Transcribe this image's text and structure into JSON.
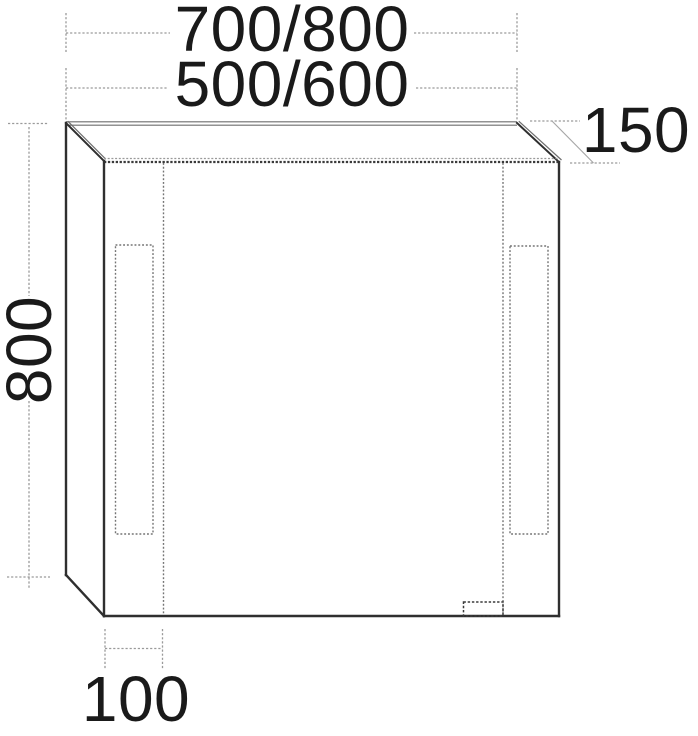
{
  "drawing": {
    "subject": "mirror-cabinet-technical-drawing",
    "dimension_labels": {
      "top_width_large": "700/800",
      "top_width_small": "500/600",
      "depth": "150",
      "height": "800",
      "bottom_inset": "100"
    },
    "colors": {
      "outline": "#2f2f2f",
      "double_edge": "#6e6e6e",
      "detail_dotted": "#757575",
      "door_gap_dark": "#3a3a3a",
      "dimension_line": "#9a9a9a",
      "label_text": "#1a1a1a",
      "background": "#ffffff"
    }
  }
}
